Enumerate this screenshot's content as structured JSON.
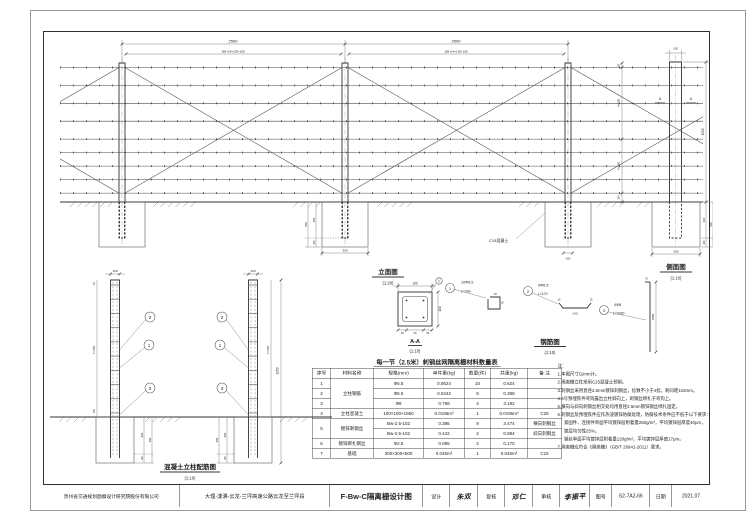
{
  "views": {
    "elevation": {
      "name": "立面图",
      "scale": "(1:20)"
    },
    "side": {
      "name": "侧面图",
      "scale": "(1:10)"
    },
    "rebar_layout": {
      "name": "混凝土立柱配筋图",
      "scale": "(1:10)"
    },
    "section": {
      "name": "A-A",
      "scale": "(1:10)"
    },
    "rebar_detail": {
      "name": "钢筋图",
      "scale": "(1:10)"
    }
  },
  "dims": {
    "panel_span": "2500",
    "panel_sub": "165+14×155+165",
    "wire_top": "50",
    "wire_upper": "4×200",
    "wire_lower": "4×150",
    "wire_bottom": "100",
    "post_above": "1550",
    "post_width": "100",
    "found_embed": "400",
    "found_gap": "100",
    "found_depth": "500",
    "found_width": "300",
    "tie_top": "50",
    "tie_mid": "7×250",
    "tie_bot": "150",
    "post_len": "1950",
    "sec_size": "100",
    "sec_cover": "25",
    "sec_mid": "50",
    "mark_a": "A",
    "c15_note": "C15混凝土"
  },
  "callouts": {
    "c1": "1",
    "c2": "2",
    "c3": "3"
  },
  "details": {
    "d1_spec": "10Φ6.5",
    "d1_len": "L=240",
    "d1_a": "70",
    "d1_b": "70",
    "d2_spec": "9Φ6.5",
    "d2_len": "L=170",
    "d2_a": "15",
    "d2_b": "140",
    "d2_c": "15",
    "d3_spec": "4Φ8",
    "d3_len": "L=2020",
    "d3_a": "70",
    "d3_b": "1950"
  },
  "table": {
    "title": "每一节（2.5米）刺钢丝网隔离栅材料数量表",
    "headers": [
      "序号",
      "材料名称",
      "规格(mm)",
      "单件重(kg)",
      "数量(件)",
      "共重(kg)",
      "备  注"
    ],
    "rows": [
      [
        "1",
        "立柱钢筋",
        "Φ6.5",
        "0.0624",
        "10",
        "0.624",
        ""
      ],
      [
        "2",
        "",
        "Φ6.5",
        "0.0442",
        "9",
        "0.398",
        ""
      ],
      [
        "3",
        "",
        "Φ8",
        "0.798",
        "4",
        "3.192",
        ""
      ],
      [
        "4",
        "立柱混凝土",
        "100×100×1950",
        "0.0195m³",
        "1",
        "0.0195m³",
        "C25"
      ],
      [
        "5",
        "镀锌刺钢丝",
        "Bw-2.5-102",
        "0.386",
        "9",
        "3.474",
        "横向刺钢丝"
      ],
      [
        "",
        "",
        "Bw-2.5-102",
        "0.442",
        "2",
        "0.884",
        "斜向刺钢丝"
      ],
      [
        "6",
        "镀锌绑扎钢丝",
        "Φ2.5",
        "0.085",
        "2",
        "0.170",
        ""
      ],
      [
        "7",
        "基础",
        "300×300×500",
        "0.045m³",
        "1",
        "0.045m³",
        "C15"
      ]
    ]
  },
  "notes": {
    "heading": "注：",
    "lines": [
      "1.本图尺寸以mm计。",
      "2.隔离栅立柱采用C25混凝土预制。",
      "3.刺钢丝采用直径2.5mm镀锌刺钢丝，捻数不小于4捻，刺间距102mm。",
      "4.3号预埋铁件弯钩露出立柱斜向上，刺钢丝绑扎于弯钩上。",
      "5.横向与斜向刺钢丝相交处均用直径2.5mm镀锌钢丝绑扎固定。",
      "6.刺钢丝及预埋铁件应作热浸镀锌防腐处理，防腐技术条件应不低于以下要求：",
      "紧固件、连接件单面平均镀锌层附着量250g/m²，平均镀锌层厚度40μm，",
      "镀层均匀性25%。",
      "钢丝单面平均镀锌层附着量120g/m²，平均镀锌层厚度17μm。",
      "7.隔离栅应符合《隔离栅》（GB/T 26941-2011）要求。"
    ]
  },
  "title_block": {
    "company": "贵州省交通规划勘察设计研究院股份有限公司",
    "project": "大理-漾濞-云龙-兰坪高速公路云龙至兰坪段",
    "drawing_title": "F-Bw-C隔离栅设计图",
    "design_label": "设计",
    "design_sig": "朱双",
    "check_label": "复核",
    "check_sig": "邓仁",
    "review_label": "审核",
    "review_sig": "李振平",
    "number_label": "图号",
    "number": "S2-7A2-66",
    "date_label": "日期",
    "date": "2021.07"
  }
}
